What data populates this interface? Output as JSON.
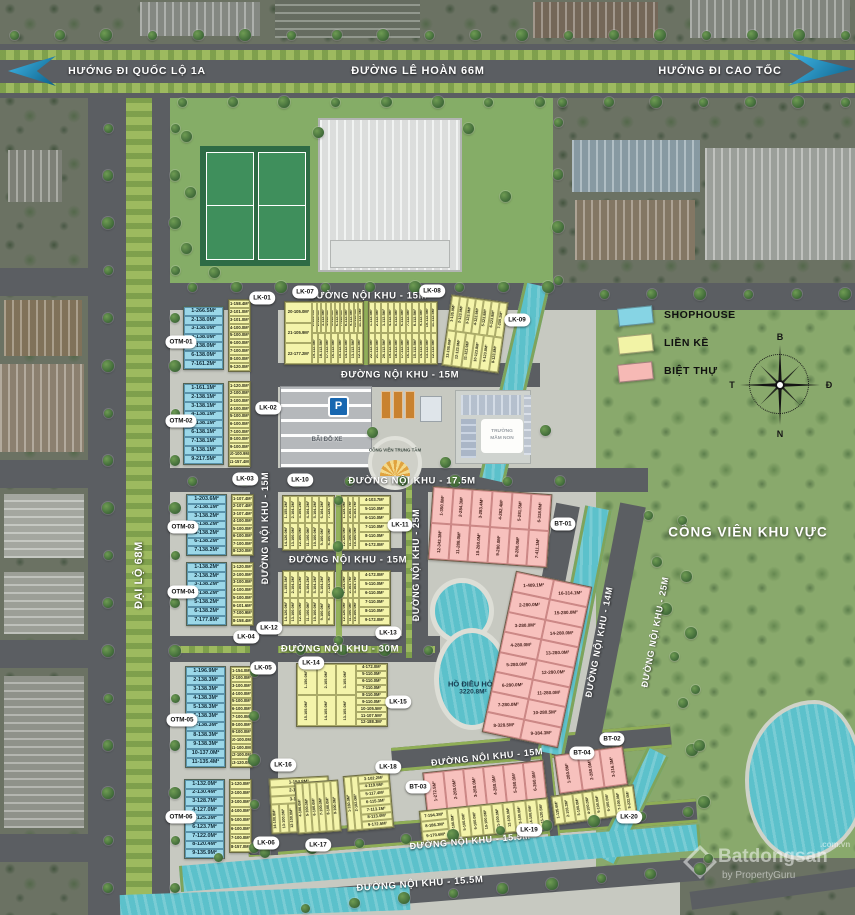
{
  "banner": {
    "left": "HƯỚNG ĐI QUỐC LỘ 1A",
    "center": "ĐƯỜNG LÊ HOÀN 66M",
    "right": "HƯỚNG ĐI CAO TỐC"
  },
  "legend": {
    "items": [
      {
        "label": "SHOPHOUSE",
        "color": "#86d4e4"
      },
      {
        "label": "LIỀN KỀ",
        "color": "#f2f3a6"
      },
      {
        "label": "BIỆT THỰ",
        "color": "#f6b9b5"
      }
    ]
  },
  "compass": {
    "north": "B",
    "east": "Đ",
    "south": "N",
    "west": "T"
  },
  "landmarks": {
    "park": "CÔNG VIÊN KHU VỰC",
    "lake_name": "HỒ ĐIỀU HÒA",
    "lake_area": "3220.8M²",
    "parking": "BÃI ĐỖ XE",
    "parking_sign": "P",
    "kindergarten_line1": "TRƯỜNG",
    "kindergarten_line2": "MẦM NON",
    "plaza": "CÔNG VIÊN TRUNG TÂM"
  },
  "watermark": {
    "brand": "Batdongsan",
    "domain": ".com.vn",
    "byline": "by PropertyGuru"
  },
  "road_labels": [
    {
      "text": "ĐẠI LỘ 68M",
      "x": 139,
      "y": 575,
      "rot": -90,
      "size": 11
    },
    {
      "text": "ĐƯỜNG NỘI KHU - 15M",
      "x": 368,
      "y": 296,
      "rot": 0,
      "size": 9.5
    },
    {
      "text": "ĐƯỜNG NỘI KHU - 15M",
      "x": 400,
      "y": 375,
      "rot": 0,
      "size": 9.5
    },
    {
      "text": "ĐƯỜNG NỘI KHU - 17.5M",
      "x": 412,
      "y": 481,
      "rot": 0,
      "size": 9.5
    },
    {
      "text": "ĐƯỜNG NỘI KHU - 15M",
      "x": 348,
      "y": 560,
      "rot": 0,
      "size": 9.5
    },
    {
      "text": "ĐƯỜNG NỘI KHU - 30M",
      "x": 340,
      "y": 649,
      "rot": 0,
      "size": 9.5
    },
    {
      "text": "ĐƯỜNG NỘI KHU - 15M",
      "x": 487,
      "y": 757,
      "rot": -6,
      "size": 9
    },
    {
      "text": "ĐƯỜNG NỘI KHU - 15.5M",
      "x": 470,
      "y": 841,
      "rot": -5,
      "size": 9
    },
    {
      "text": "ĐƯỜNG NỘI KHU - 15.5M",
      "x": 420,
      "y": 884,
      "rot": -4,
      "size": 9.5
    },
    {
      "text": "ĐƯỜNG NỘI KHU - 15M",
      "x": 265,
      "y": 528,
      "rot": -90,
      "size": 9
    },
    {
      "text": "ĐƯỜNG NỘI KHU - 25M",
      "x": 416,
      "y": 565,
      "rot": -90,
      "size": 9
    },
    {
      "text": "ĐƯỜNG NỘI KHU - 14M",
      "x": 599,
      "y": 642,
      "rot": -79,
      "size": 9
    },
    {
      "text": "ĐƯỜNG NỘI KHU - 25M",
      "x": 655,
      "y": 632,
      "rot": -79,
      "size": 9
    }
  ],
  "badges": [
    {
      "label": "LK-01",
      "x": 262,
      "y": 298
    },
    {
      "label": "LK-02",
      "x": 268,
      "y": 408
    },
    {
      "label": "LK-03",
      "x": 245,
      "y": 479
    },
    {
      "label": "LK-04",
      "x": 246,
      "y": 637
    },
    {
      "label": "LK-05",
      "x": 263,
      "y": 668
    },
    {
      "label": "LK-06",
      "x": 266,
      "y": 843
    },
    {
      "label": "LK-07",
      "x": 305,
      "y": 292
    },
    {
      "label": "LK-08",
      "x": 432,
      "y": 291
    },
    {
      "label": "LK-09",
      "x": 517,
      "y": 320
    },
    {
      "label": "LK-10",
      "x": 300,
      "y": 480
    },
    {
      "label": "LK-11",
      "x": 400,
      "y": 525
    },
    {
      "label": "LK-12",
      "x": 269,
      "y": 628
    },
    {
      "label": "LK-13",
      "x": 388,
      "y": 633
    },
    {
      "label": "LK-14",
      "x": 311,
      "y": 663
    },
    {
      "label": "LK-15",
      "x": 398,
      "y": 702
    },
    {
      "label": "LK-16",
      "x": 283,
      "y": 765
    },
    {
      "label": "LK-17",
      "x": 318,
      "y": 845
    },
    {
      "label": "LK-18",
      "x": 388,
      "y": 767
    },
    {
      "label": "LK-19",
      "x": 529,
      "y": 830
    },
    {
      "label": "LK-20",
      "x": 629,
      "y": 817
    },
    {
      "label": "BT-01",
      "x": 563,
      "y": 524
    },
    {
      "label": "BT-02",
      "x": 612,
      "y": 739
    },
    {
      "label": "BT-03",
      "x": 418,
      "y": 787
    },
    {
      "label": "BT-04",
      "x": 582,
      "y": 753
    },
    {
      "label": "OTM-01",
      "x": 181,
      "y": 342
    },
    {
      "label": "OTM-02",
      "x": 181,
      "y": 421
    },
    {
      "label": "OTM-03",
      "x": 183,
      "y": 527
    },
    {
      "label": "OTM-04",
      "x": 183,
      "y": 592
    },
    {
      "label": "OTM-05",
      "x": 182,
      "y": 720
    },
    {
      "label": "OTM-06",
      "x": 181,
      "y": 817
    }
  ],
  "blocks": [
    {
      "id": "OTM-01",
      "color": "blue",
      "x": 183,
      "y": 306,
      "w": 41,
      "h": 64,
      "rows": [
        "1-266.5M²",
        "2-138.0M²",
        "3-138.0M²",
        "4-138.0M²",
        "5-138.0M²",
        "6-138.0M²",
        "7-161.2M²"
      ]
    },
    {
      "id": "LK-01-col",
      "color": "yellow",
      "x": 228,
      "y": 299,
      "w": 23,
      "h": 73,
      "rows": [
        "1-158.4M²",
        "2-101.0M²",
        "3-101.0M²",
        "4-100.0M²",
        "5-100.0M²",
        "6-100.0M²",
        "7-100.0M²",
        "8-100.0M²",
        "9-120.0M²"
      ]
    },
    {
      "id": "OTM-02",
      "color": "blue",
      "x": 183,
      "y": 383,
      "w": 41,
      "h": 82,
      "rows": [
        "1-161.1M²",
        "2-138.1M²",
        "3-138.1M²",
        "4-138.1M²",
        "5-138.1M²",
        "6-138.1M²",
        "7-138.1M²",
        "8-138.1M²",
        "9-217.5M²"
      ]
    },
    {
      "id": "LK-02-col",
      "color": "yellow",
      "x": 228,
      "y": 381,
      "w": 23,
      "h": 86,
      "rows": [
        "1-120.0M²",
        "2-100.0M²",
        "3-100.0M²",
        "4-100.0M²",
        "5-100.0M²",
        "6-100.0M²",
        "7-100.0M²",
        "8-100.0M²",
        "9-100.0M²",
        "10-100.9M²",
        "11-157.4M²"
      ]
    },
    {
      "id": "OTM-03",
      "color": "blue",
      "x": 186,
      "y": 494,
      "w": 41,
      "h": 62,
      "rows": [
        "1-203.6M²",
        "2-138.1M²",
        "3-138.2M²",
        "4-138.2M²",
        "5-138.2M²",
        "6-138.2M²",
        "7-138.2M²"
      ]
    },
    {
      "id": "LK-03-col",
      "color": "yellow",
      "x": 231,
      "y": 494,
      "w": 23,
      "h": 62,
      "rows": [
        "1-107.4M²",
        "2-107.4M²",
        "3-107.4M²",
        "4-100.0M²",
        "5-100.0M²",
        "6-100.0M²",
        "7-100.0M²",
        "8-120.0M²"
      ]
    },
    {
      "id": "OTM-04",
      "color": "blue",
      "x": 186,
      "y": 562,
      "w": 41,
      "h": 64,
      "rows": [
        "1-138.2M²",
        "2-138.2M²",
        "3-138.2M²",
        "4-138.2M²",
        "5-138.2M²",
        "6-138.2M²",
        "7-177.8M²"
      ]
    },
    {
      "id": "LK-12-col",
      "color": "yellow",
      "x": 231,
      "y": 562,
      "w": 23,
      "h": 64,
      "rows": [
        "1-120.0M²",
        "2-100.0M²",
        "3-100.0M²",
        "4-100.0M²",
        "5-100.0M²",
        "6-101.6M²",
        "7-100.9M²",
        "8-158.4M²"
      ]
    },
    {
      "id": "OTM-05",
      "color": "blue",
      "x": 185,
      "y": 666,
      "w": 41,
      "h": 102,
      "rows": [
        "1-196.9M²",
        "2-138.3M²",
        "3-138.3M²",
        "4-138.3M²",
        "5-138.3M²",
        "6-138.3M²",
        "7-138.3M²",
        "8-138.3M²",
        "9-138.3M²",
        "10-137.0M²",
        "11-135.4M²"
      ]
    },
    {
      "id": "LK-05-col",
      "color": "yellow",
      "x": 230,
      "y": 666,
      "w": 23,
      "h": 102,
      "rows": [
        "1-154.0M²",
        "2-100.0M²",
        "3-100.0M²",
        "4-100.0M²",
        "5-100.0M²",
        "6-100.0M²",
        "7-100.0M²",
        "8-100.0M²",
        "9-100.0M²",
        "10-100.0M²",
        "11-100.0M²",
        "12-100.0M²",
        "13-120.0M²"
      ]
    },
    {
      "id": "OTM-06",
      "color": "blue",
      "x": 184,
      "y": 779,
      "w": 41,
      "h": 80,
      "rows": [
        "1-132.0M²",
        "2-130.4M²",
        "3-128.7M²",
        "4-127.0M²",
        "5-125.3M²",
        "6-123.7M²",
        "7-122.0M²",
        "8-120.4M²",
        "9-135.9M²"
      ]
    },
    {
      "id": "LK-06-col",
      "color": "yellow",
      "x": 229,
      "y": 779,
      "w": 23,
      "h": 74,
      "rows": [
        "1-120.0M²",
        "2-100.0M²",
        "3-100.0M²",
        "4-100.0M²",
        "5-100.0M²",
        "6-100.0M²",
        "7-100.0M²",
        "8-157.0M²"
      ]
    },
    {
      "id": "LK-07-blk",
      "color": "yellow",
      "x": 284,
      "y": 301,
      "w": 80,
      "h": 64,
      "left": [
        "20-105.0M²",
        "21-105.9M²",
        "22-177.2M²"
      ],
      "top": [
        "1-153.9M²",
        "2-112.5M²",
        "3-112.5M²",
        "4-112.5M²",
        "5-112.5M²",
        "6-112.5M²",
        "7-112.5M²",
        "8-112.5M²",
        "9-112.5M²",
        "10-112.5M²",
        "11-112.5M²"
      ],
      "bottom": [
        "19-112.5M²",
        "18-112.5M²",
        "17-112.5M²",
        "16-112.5M²",
        "15-112.5M²",
        "14-112.5M²",
        "13-112.5M²",
        "12-112.5M²"
      ]
    },
    {
      "id": "LK-08-blk",
      "color": "yellow",
      "x": 368,
      "y": 301,
      "w": 70,
      "h": 64,
      "top": [
        "1-112.5M²",
        "2-112.5M²",
        "3-112.5M²",
        "4-112.5M²",
        "5-112.5M²",
        "6-112.5M²",
        "7-112.5M²",
        "8-112.5M²",
        "9-112.5M²",
        "10-112.5M²",
        "11-112.5M²"
      ],
      "bottom": [
        "22-112.5M²",
        "21-112.5M²",
        "20-112.5M²",
        "19-112.5M²",
        "18-112.5M²",
        "17-112.5M²",
        "16-112.5M²",
        "15-112.5M²",
        "14-112.5M²",
        "13-112.5M²",
        "12-112.5M²"
      ]
    },
    {
      "id": "LK-09-blk",
      "color": "yellow",
      "x": 446,
      "y": 298,
      "w": 58,
      "h": 72,
      "rot": 8,
      "top": [
        "1-135.9M²",
        "2-123.9M²",
        "3-123.9M²",
        "4-123.9M²",
        "5-123.8M²",
        "6-123.8M²",
        "7-259.1M²"
      ],
      "bottom": [
        "13-105.0M²",
        "12-123.9M²",
        "11-123.9M²",
        "10-123.8M²",
        "9-123.8M²",
        "8-123.8M²"
      ]
    },
    {
      "id": "LK-10-blk-a",
      "color": "yellow",
      "x": 282,
      "y": 495,
      "w": 53,
      "h": 56,
      "top": [
        "1-155.2M²",
        "2-104.2M²",
        "3-104.2M²",
        "4-104.2M²",
        "5-104.2M²",
        "6-104.2M²",
        "7-124.0M²"
      ],
      "bottom": [
        "14-120.0M²",
        "13-100.0M²",
        "12-100.0M²",
        "11-100.0M²",
        "10-100.0M²",
        "9-100.0M²",
        "8-100.0M²"
      ]
    },
    {
      "id": "LK-11-blk",
      "color": "yellow",
      "x": 341,
      "y": 495,
      "w": 50,
      "h": 56,
      "right": [
        "4-103.7M²",
        "5-110.0M²",
        "6-110.0M²",
        "7-110.0M²",
        "8-110.0M²",
        "9-172.0M²"
      ],
      "top": [
        "1-124.0M²",
        "2-103.7M²",
        "3-103.7M²"
      ],
      "bottom": [
        "12-120.0M²",
        "11-100.0M²",
        "10-100.0M²"
      ]
    },
    {
      "id": "LK-10-blk-b",
      "color": "yellow",
      "x": 282,
      "y": 570,
      "w": 53,
      "h": 56,
      "top": [
        "1-155.3M²",
        "2-104.2M²",
        "3-104.2M²",
        "4-104.2M²",
        "5-104.2M²",
        "6-104.2M²",
        "7-124.0M²"
      ],
      "bottom": [
        "14-120.0M²",
        "13-100.0M²",
        "12-100.0M²",
        "11-100.0M²",
        "10-100.0M²",
        "9-100.0M²",
        "8-100.0M²"
      ]
    },
    {
      "id": "LK-13-blk",
      "color": "yellow",
      "x": 341,
      "y": 570,
      "w": 50,
      "h": 56,
      "right": [
        "4-172.0M²",
        "5-110.0M²",
        "6-110.0M²",
        "7-110.0M²",
        "8-110.0M²",
        "9-172.0M²"
      ],
      "top": [
        "1-124.0M²",
        "2-103.7M²",
        "3-103.7M²"
      ],
      "bottom": [
        "12-120.0M²",
        "11-100.0M²",
        "10-100.0M²"
      ]
    },
    {
      "id": "LK-14-blk",
      "color": "yellow",
      "x": 296,
      "y": 663,
      "w": 92,
      "h": 64,
      "right": [
        "4-172.0M²",
        "5-110.0M²",
        "6-110.0M²",
        "7-110.0M²",
        "8-110.0M²",
        "9-110.0M²",
        "10-105.5M²",
        "11-107.5M²",
        "12-188.3M²"
      ],
      "top": [
        "1-150.0M²",
        "2-105.0M²",
        "3-105.0M²"
      ],
      "bottom": [
        "15-105.0M²",
        "14-105.0M²",
        "13-105.0M²"
      ]
    },
    {
      "id": "LK-16-blk",
      "color": "yellow",
      "x": 270,
      "y": 777,
      "w": 60,
      "h": 56,
      "rot": -3,
      "rows": [
        "1-154.8M²",
        "2-102.3M²",
        "3-104.4M²"
      ],
      "bottom": [
        "14-100.8M²",
        "13-100.0M²",
        "12-100.0M²",
        "11-100.0M²",
        "10-100.0M²",
        "9-100.0M²",
        "8-100.0M²"
      ]
    },
    {
      "id": "LK-17-blk",
      "color": "yellow",
      "x": 296,
      "y": 781,
      "w": 44,
      "h": 52,
      "rot": -4,
      "top": [
        "4-100.0M²",
        "5-100.0M²",
        "6-100.0M²",
        "7-100.0M²",
        "8-100.0M²",
        "9-100.0M²"
      ]
    },
    {
      "id": "LK-18-blk",
      "color": "yellow",
      "x": 345,
      "y": 774,
      "w": 47,
      "h": 56,
      "rot": -5,
      "right": [
        "3-102.2M²",
        "4-119.5M²",
        "5-117.4M²",
        "6-115.3M²",
        "7-113.1M²",
        "8-113.0M²",
        "9-172.5M²"
      ],
      "top": [
        "1-160.0M²",
        "2-102.0M²"
      ]
    },
    {
      "id": "BT-01-blk",
      "color": "pink",
      "x": 430,
      "y": 490,
      "w": 120,
      "h": 74,
      "rot": 4,
      "top": [
        "1-350.0M²",
        "2-284.3M²",
        "3-283.4M²",
        "4-282.4M²",
        "5-281.5M²",
        "6-318.0M²"
      ],
      "bottom": [
        "12-343.3M²",
        "11-288.0M²",
        "10-280.0M²",
        "9-280.0M²",
        "8-280.0M²",
        "7-411.1M²"
      ]
    },
    {
      "id": "BT-02-blk",
      "color": "pink",
      "x": 498,
      "y": 577,
      "w": 78,
      "h": 165,
      "rot": 12,
      "rows2": [
        [
          "1-409.1M²",
          "16-314.1M²"
        ],
        [
          "2-280.0M²",
          "15-280.0M²"
        ],
        [
          "3-280.0M²",
          "14-280.0M²"
        ],
        [
          "4-280.0M²",
          "13-280.0M²"
        ],
        [
          "5-280.0M²",
          "12-280.0M²"
        ],
        [
          "6-280.0M²",
          "11-280.0M²"
        ],
        [
          "7-280.0M²",
          "10-280.5M²"
        ],
        [
          "8-328.5M²",
          "9-384.3M²"
        ]
      ]
    },
    {
      "id": "BT-03-blk",
      "color": "pink",
      "x": 424,
      "y": 766,
      "w": 122,
      "h": 40,
      "rot": -6,
      "top": [
        "1-272.5M²",
        "2-260.0M²",
        "3-260.0M²",
        "4-260.0M²",
        "5-260.0M²",
        "6-260.0M²"
      ]
    },
    {
      "id": "LK-19-blk",
      "color": "yellow",
      "x": 420,
      "y": 804,
      "w": 130,
      "h": 32,
      "rot": -6,
      "left": [
        "7-194.3M²",
        "8-186.3M²",
        "9-170.6M²"
      ],
      "top": [
        "4-100.0M²",
        "5-100.0M²",
        "6-100.0M²",
        "10-100.0M²",
        "11-100.0M²",
        "12-100.0M²",
        "13-100.0M²",
        "14-100.0M²",
        "15-120.5M²"
      ]
    },
    {
      "id": "BT-04-blk",
      "color": "pink",
      "x": 556,
      "y": 750,
      "w": 70,
      "h": 40,
      "rot": -8,
      "top": [
        "1-280.0M²",
        "2-280.0M²",
        "3-316.3M²"
      ]
    },
    {
      "id": "LK-20-blk",
      "color": "yellow",
      "x": 552,
      "y": 790,
      "w": 84,
      "h": 30,
      "rot": -8,
      "top": [
        "1-135.6M²",
        "2-103.3M²",
        "3-100.0M²",
        "4-100.0M²",
        "5-100.0M²",
        "6-100.0M²",
        "7-100.0M²",
        "8-222.0M²"
      ]
    }
  ]
}
